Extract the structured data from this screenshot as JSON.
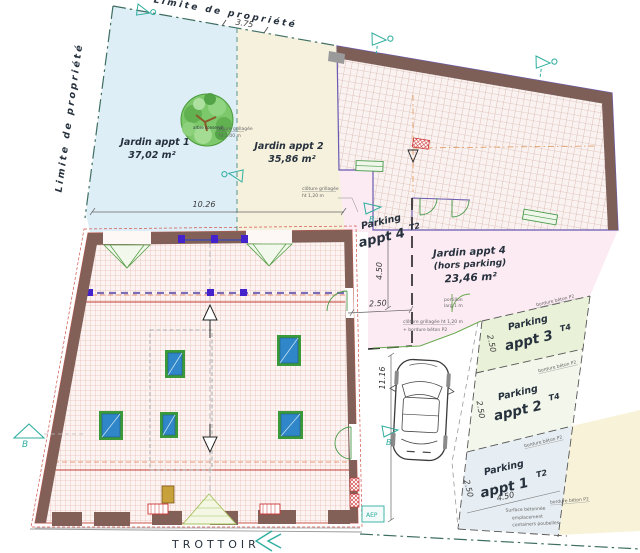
{
  "plan": {
    "boundary": {
      "label_left": "Limite de propriété",
      "label_top": "Limite de propriété"
    },
    "dims": {
      "top": "3.75",
      "width": "10.26",
      "p4_height": "4.50",
      "p4_width": "2.50",
      "height": "11.16",
      "p3_depth": "2.50",
      "p2_depth": "2.50",
      "p1_depth": "2.50",
      "p1_width": "4.50"
    },
    "zones": {
      "jardin1": {
        "name": "Jardin appt 1",
        "area": "37,02 m²"
      },
      "jardin2": {
        "name": "Jardin appt 2",
        "area": "35,86 m²"
      },
      "jardin4": {
        "name": "Jardin appt 4",
        "note": "(hors parking)",
        "area": "23,46 m²"
      },
      "parking4": {
        "prefix": "Parking",
        "name": "appt 4",
        "type": "T2"
      },
      "parking3": {
        "prefix": "Parking",
        "name": "appt 3",
        "type": "T4"
      },
      "parking2": {
        "prefix": "Parking",
        "name": "appt 2",
        "type": "T4"
      },
      "parking1": {
        "prefix": "Parking",
        "name": "appt 1",
        "type": "T2"
      }
    },
    "annotations": {
      "fence_tree_1": "clôture grillagée",
      "fence_tree_2": "ht 2.00 m",
      "fence_mid_1": "clôture grillagée",
      "fence_mid_2": "ht 1,20 m",
      "fence_low_1": "clôture grillagée ht 1,20 m",
      "fence_low_2": "+ bordure béton P2",
      "gate_1": "portillon",
      "gate_2": "larg 1 m",
      "tree": "arbre conservé",
      "bordure": "bordure béton P2",
      "surface_1": "Surface bétonnée",
      "surface_2": "emplacement",
      "surface_3": "containers poubelles",
      "aep": "AEP",
      "section_letter": "B",
      "sidewalk": "TROTTOIR"
    },
    "colors": {
      "jardin1_fill": "#ddeef6",
      "jardin2_fill": "#f6f1dd",
      "pink_zone": "#fcebf3",
      "parking3_fill": "#e9f1d8",
      "parking2_fill": "#f3f7eb",
      "parking1_fill": "#e7eef3",
      "concrete_fill": "#f8f3d8",
      "roof_hatch": "#dd9a8e",
      "wall_brown": "#826058",
      "boundary_green": "#3e6e62",
      "marker_teal": "#2fae9f",
      "velux_blue": "#2f86c8",
      "velux_green": "#3a9a3a",
      "ridge_red": "#c23b32"
    }
  }
}
